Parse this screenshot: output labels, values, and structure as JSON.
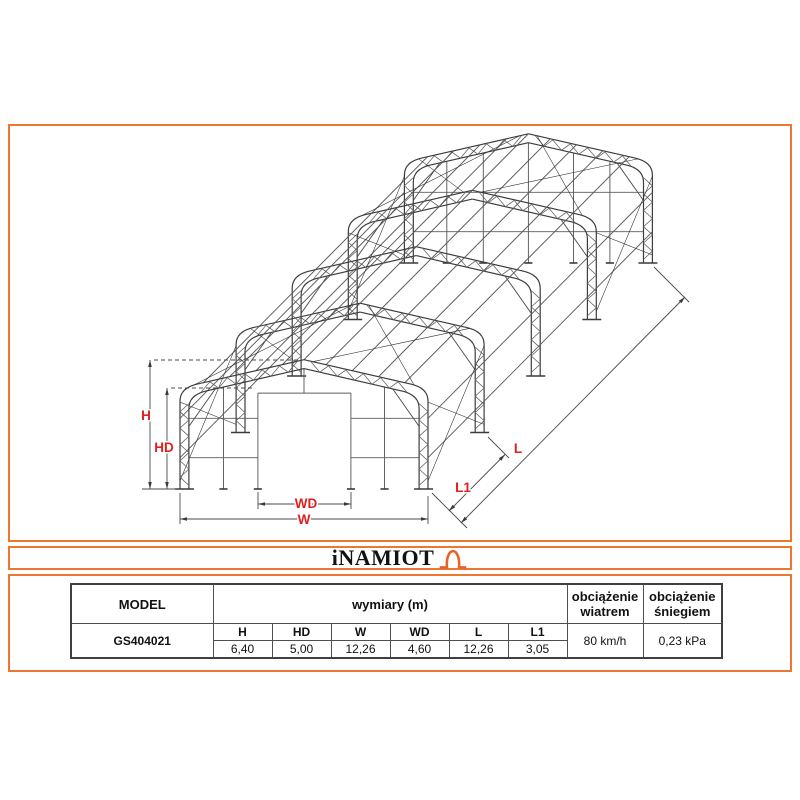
{
  "accent_color": "#ED7633",
  "logo": {
    "text": "iNAMIOT"
  },
  "drawing": {
    "label_color": "#E01F1F",
    "labels": {
      "h": "H",
      "hd": "HD",
      "w": "W",
      "wd": "WD",
      "l": "L",
      "l1": "L1"
    }
  },
  "table": {
    "headers": {
      "model": "MODEL",
      "dims": "wymiary (m)",
      "wind": "obciążenie wiatrem",
      "snow": "obciążenie śniegiem"
    },
    "dim_labels": [
      "H",
      "HD",
      "W",
      "WD",
      "L",
      "L1"
    ],
    "row": {
      "model": "GS404021",
      "values": [
        "6,40",
        "5,00",
        "12,26",
        "4,60",
        "12,26",
        "3,05"
      ],
      "wind": "80 km/h",
      "snow": "0,23 kPa"
    }
  }
}
